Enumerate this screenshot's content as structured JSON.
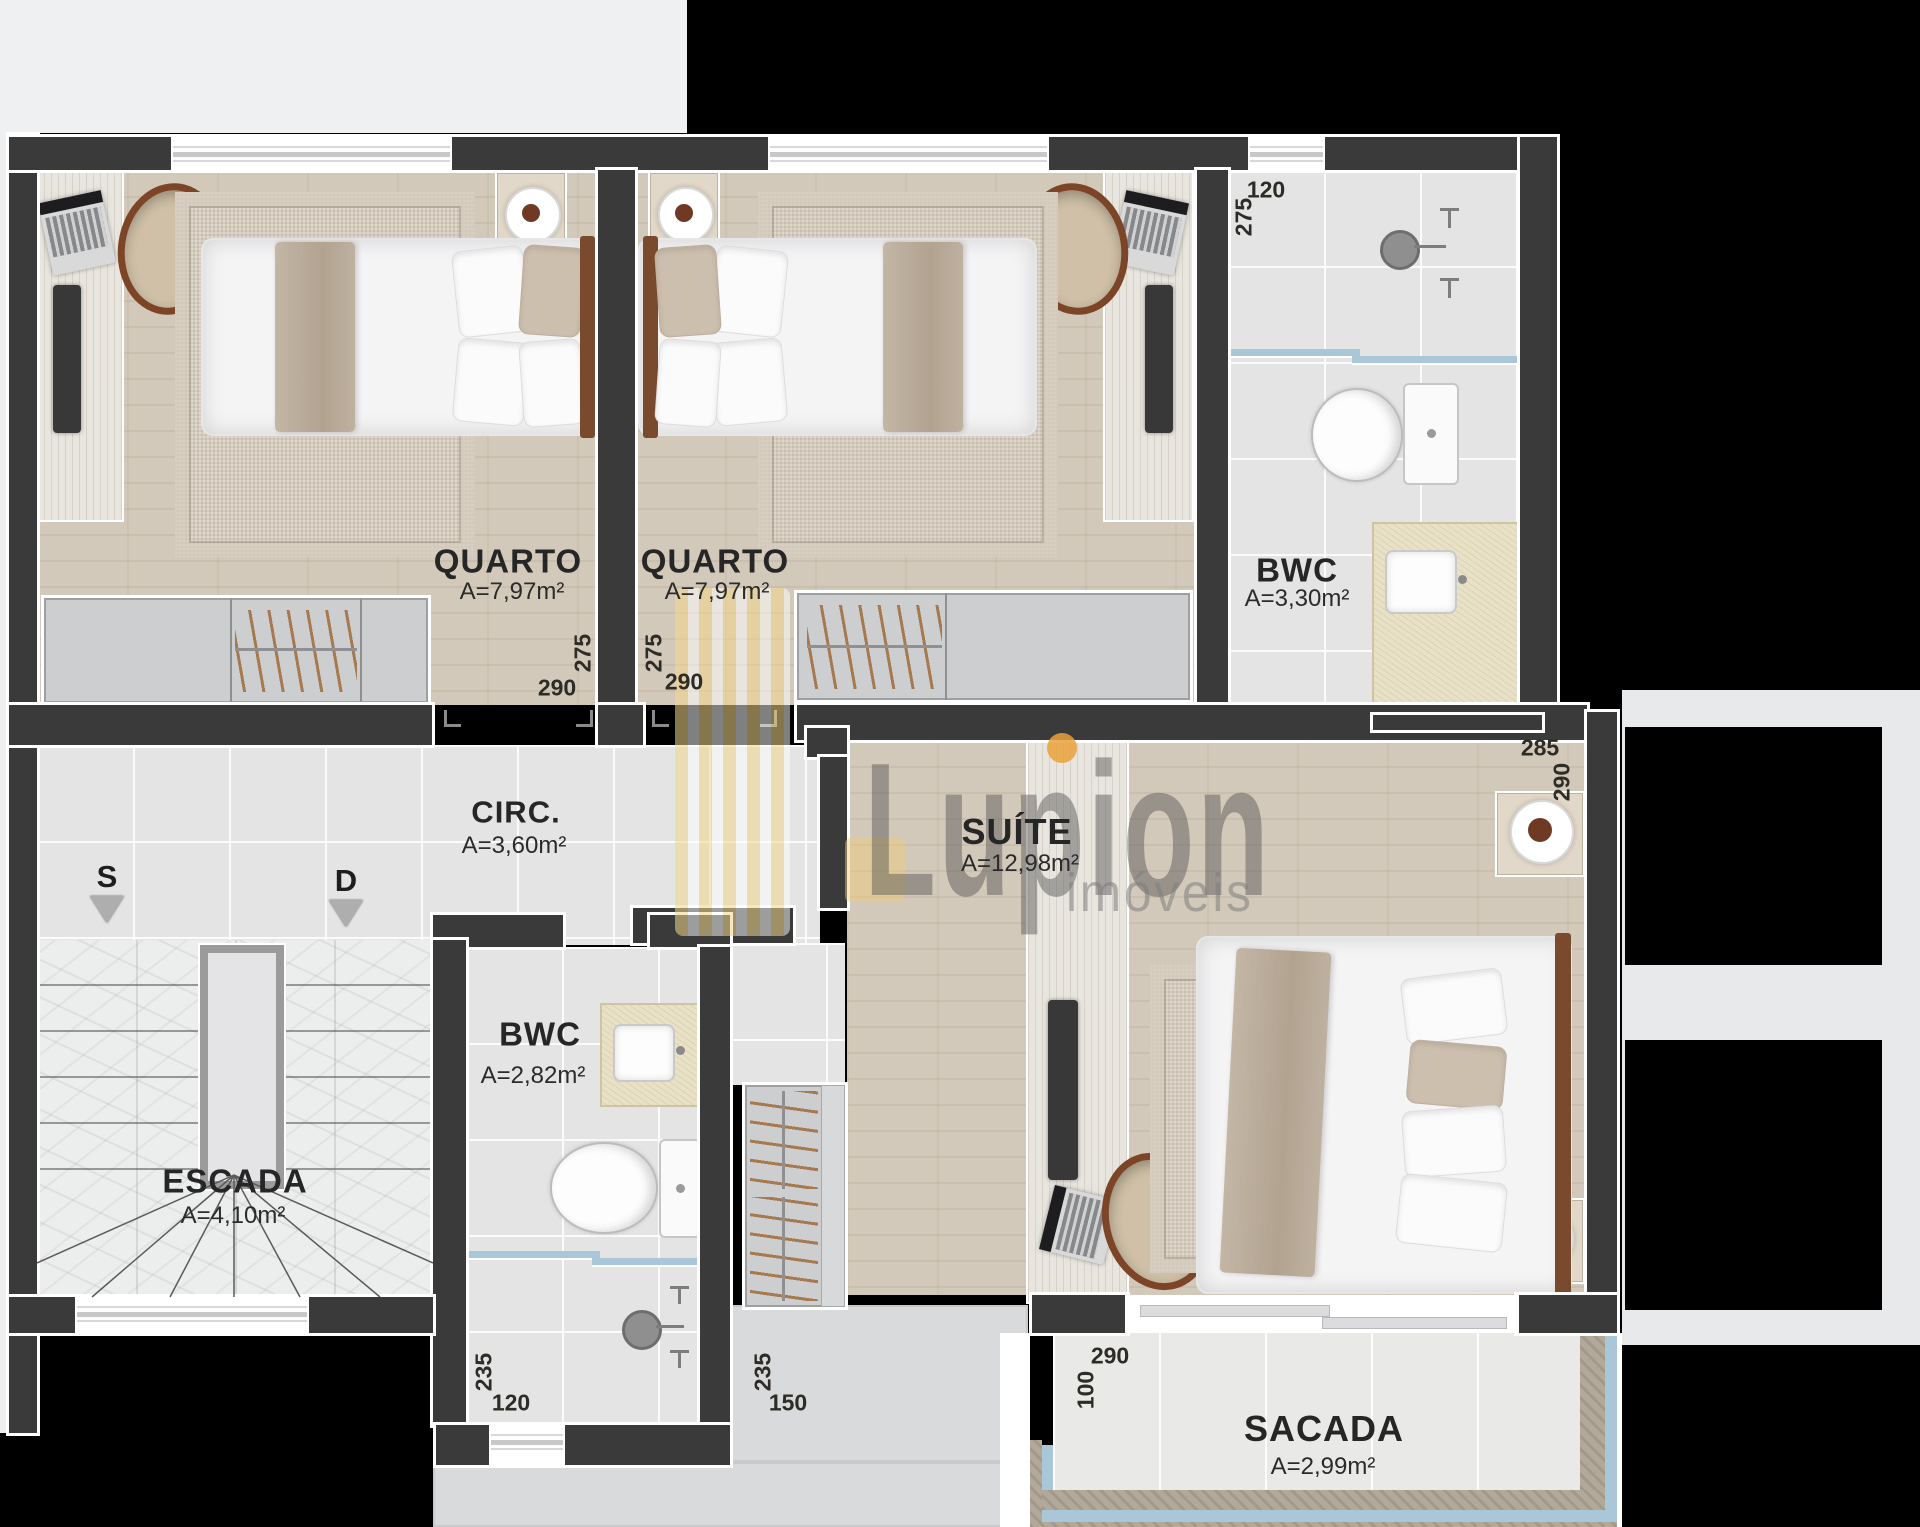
{
  "watermark": {
    "brand": "Lupion",
    "tagline": "imóveis"
  },
  "rooms": {
    "quarto1": {
      "name": "QUARTO",
      "area": "A=7,97m²",
      "dim_depth": "275",
      "dim_width": "290"
    },
    "quarto2": {
      "name": "QUARTO",
      "area": "A=7,97m²",
      "dim_depth": "275",
      "dim_width": "290"
    },
    "bwc_top": {
      "name": "BWC",
      "area": "A=3,30m²",
      "dim_width": "120",
      "dim_depth": "275"
    },
    "circulation": {
      "name": "CIRC.",
      "area": "A=3,60m²"
    },
    "suite": {
      "name": "SUÍTE",
      "area": "A=12,98m²",
      "dim_width": "285",
      "dim_depth": "290"
    },
    "stairs": {
      "name": "ESCADA",
      "area": "A=4,10m²",
      "arrow_up_label": "S",
      "arrow_down_label": "D"
    },
    "bwc_lower": {
      "name": "BWC",
      "area": "A=2,82m²",
      "dim_depth": "235",
      "dim_width": "120"
    },
    "closet": {
      "dim_depth": "235",
      "dim_width": "150"
    },
    "balcony": {
      "name": "SACADA",
      "area": "A=2,99m²",
      "dim_depth": "100",
      "dim_width": "290"
    }
  }
}
